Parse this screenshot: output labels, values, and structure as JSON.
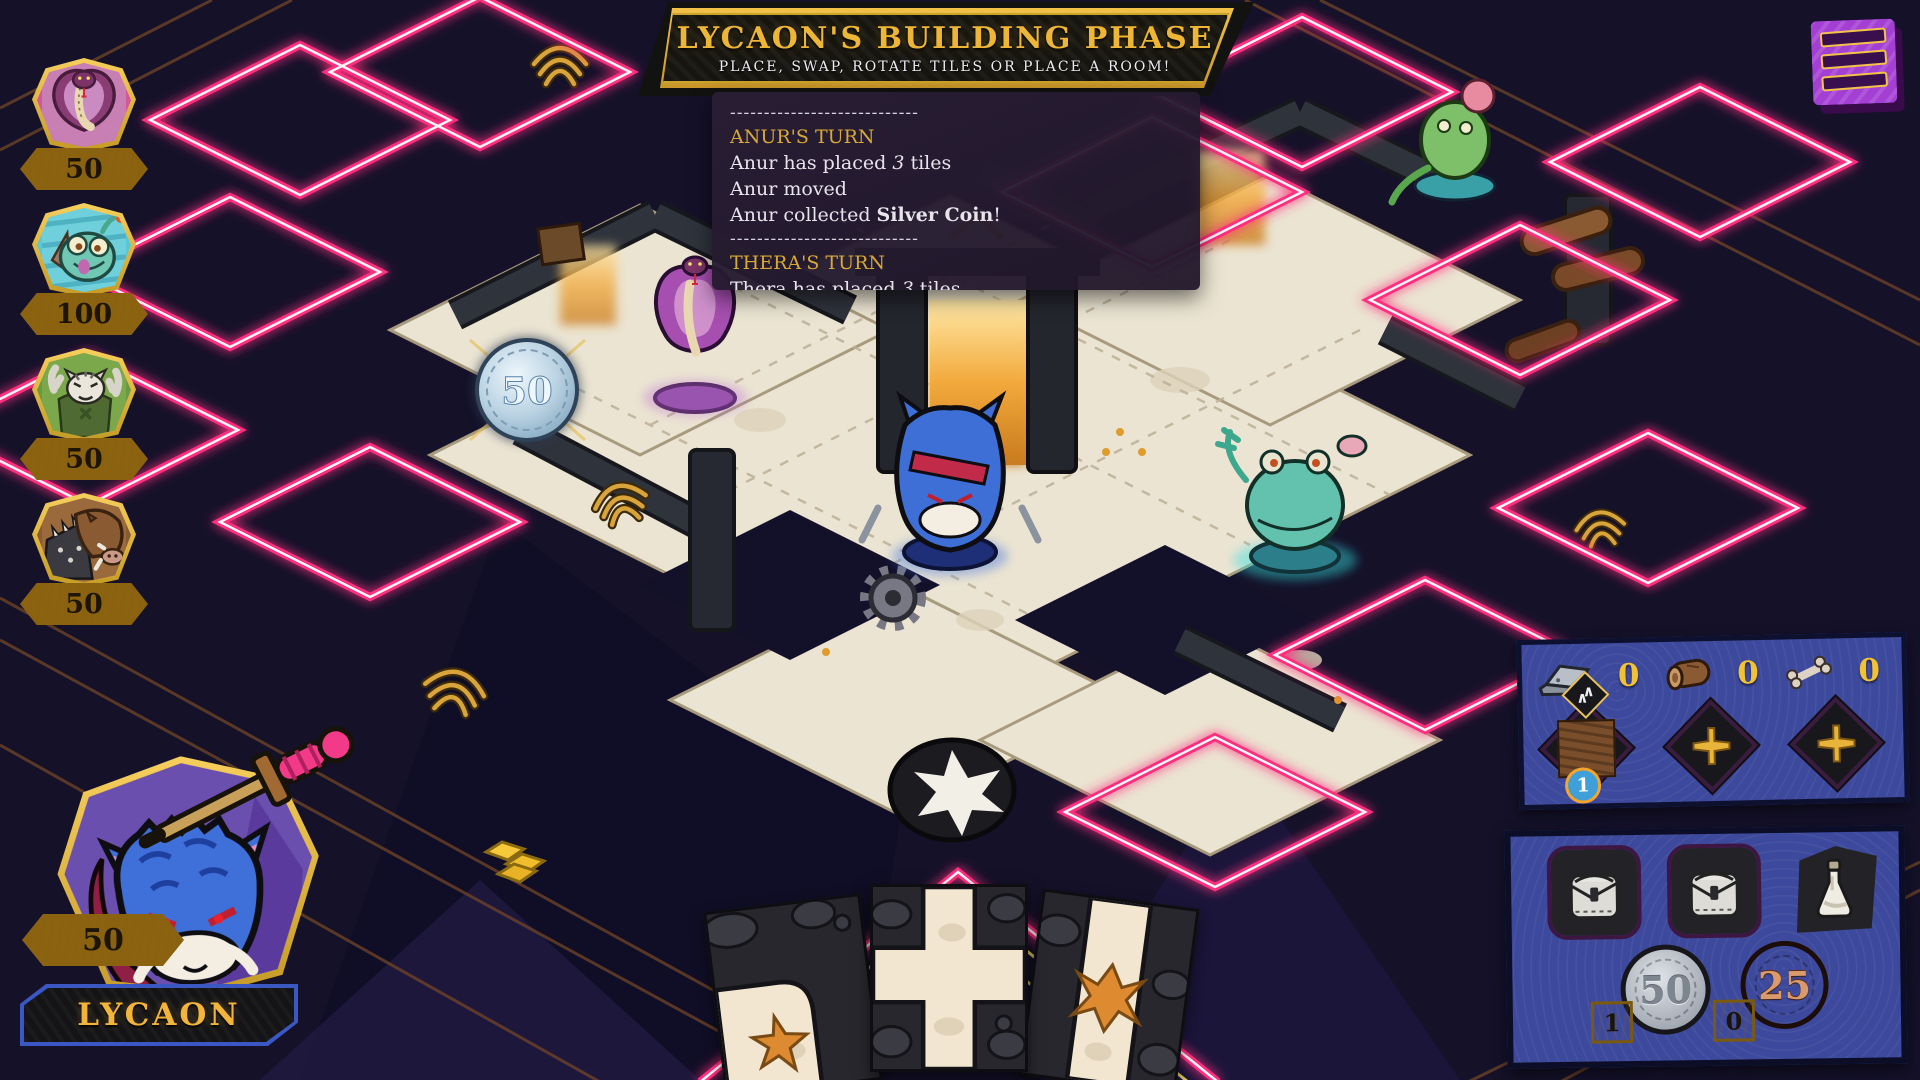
{
  "colors": {
    "accent_gold": "#f2b933",
    "neon_pink": "#ff2e7e",
    "panel_blue": "#3d499c",
    "log_gold": "#d9a937",
    "menu_purple": "#a43fd4",
    "board_tile_cream": "#ebe4d2"
  },
  "banner": {
    "title": "LYCAON'S BUILDING PHASE",
    "subtitle": "PLACE, SWAP, ROTATE TILES OR PLACE A ROOM!"
  },
  "log": {
    "divider": "----------------------------",
    "turns": [
      {
        "header": "ANUR'S TURN",
        "lines": [
          {
            "pre": "Anur has placed ",
            "em": "3",
            "post": " tiles"
          },
          {
            "pre": "Anur moved",
            "em": "",
            "post": ""
          },
          {
            "pre": "Anur collected ",
            "strong": "Silver Coin",
            "post": "!"
          }
        ]
      },
      {
        "header": "THERA'S TURN",
        "lines": [
          {
            "pre": "Thera has placed ",
            "em": "3",
            "post": " tiles"
          },
          {
            "pre": "Thera moved",
            "em": "",
            "post": ""
          }
        ]
      }
    ]
  },
  "players": [
    {
      "score": "50",
      "avatar": "cobra-avatar"
    },
    {
      "score": "100",
      "avatar": "axolotl-avatar"
    },
    {
      "score": "50",
      "avatar": "tiger-avatar"
    },
    {
      "score": "50",
      "avatar": "boar-avatar"
    }
  ],
  "current_player": {
    "name": "LYCAON",
    "score": "50",
    "avatar": "blue-werewolf-avatar"
  },
  "board": {
    "coin_token_value": "50"
  },
  "hand": {
    "cards": [
      {
        "name": "corner-path-tile"
      },
      {
        "name": "cross-path-tile"
      },
      {
        "name": "straight-path-tile"
      }
    ]
  },
  "resources": {
    "iron": "0",
    "wood": "0",
    "bone": "0",
    "tile_stack_count": "1",
    "chevron_badge": "upgrade-chevrons-icon",
    "empty_slot_icon": "gold-cross-icon"
  },
  "inventory": {
    "slot1": "pouch-icon",
    "slot2": "pouch-icon",
    "slot3": "flask-icon",
    "silver_coin_value": "50",
    "silver_coin_count": "1",
    "copper_coin_value": "25",
    "copper_coin_count": "0"
  },
  "menu": {
    "icon": "hamburger-menu-icon"
  }
}
